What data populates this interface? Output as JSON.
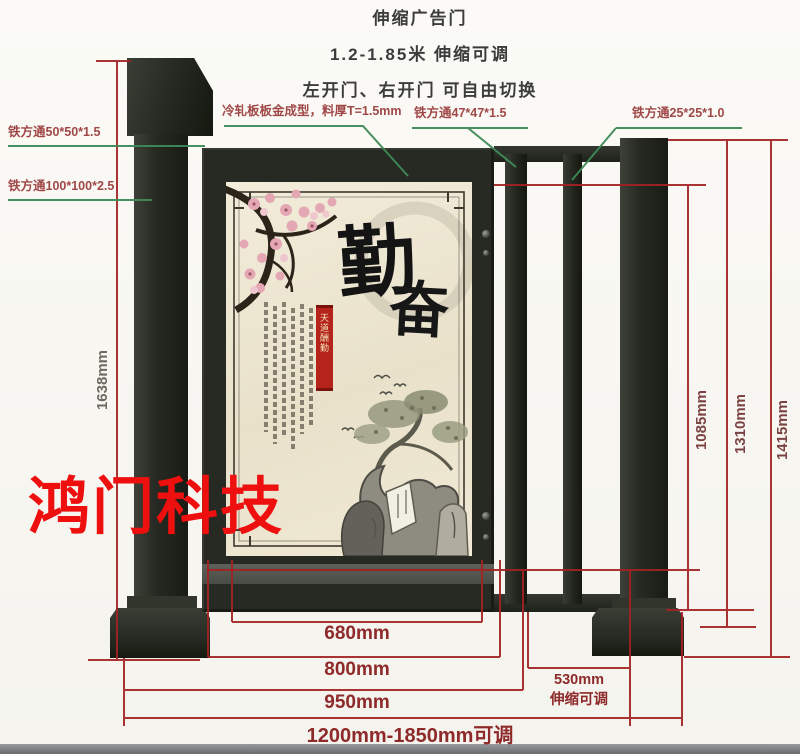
{
  "header": {
    "line1": "伸缩广告门",
    "line2": "1.2-1.85米 伸缩可调",
    "line3": "左开门、右开门 可自由切换"
  },
  "labels": {
    "steel_50": "铁方通50*50*1.5",
    "steel_100": "铁方通100*100*2.5",
    "cold_rolled": "冷轧板板金成型，料厚T=1.5mm",
    "steel_47": "铁方通47*47*1.5",
    "steel_25": "铁方通25*25*1.0"
  },
  "dims": {
    "left_height": "1638mm",
    "right_heights": [
      "1085mm",
      "1310mm",
      "1415mm"
    ],
    "bottom": [
      "680mm",
      "800mm",
      "950mm"
    ],
    "bottom_range": "1200mm-1850mm可调",
    "telescopic": {
      "width": "530mm",
      "note": "伸缩可调"
    }
  },
  "watermark": {
    "text": "鸿门科技"
  },
  "poster": {
    "char_main": "勤",
    "char_sub": "奋",
    "seal_text": "天道酬勤"
  },
  "colors": {
    "metal_dark": "#262a22",
    "dimension_line": "#a32222",
    "leader_line": "#3f8a58",
    "label_text": "#a04848",
    "dim_text": "#8e2a2a",
    "watermark_red": "#ee0f0f",
    "poster_cream": "#ebe3cd",
    "header_text": "#3c3c3c"
  }
}
